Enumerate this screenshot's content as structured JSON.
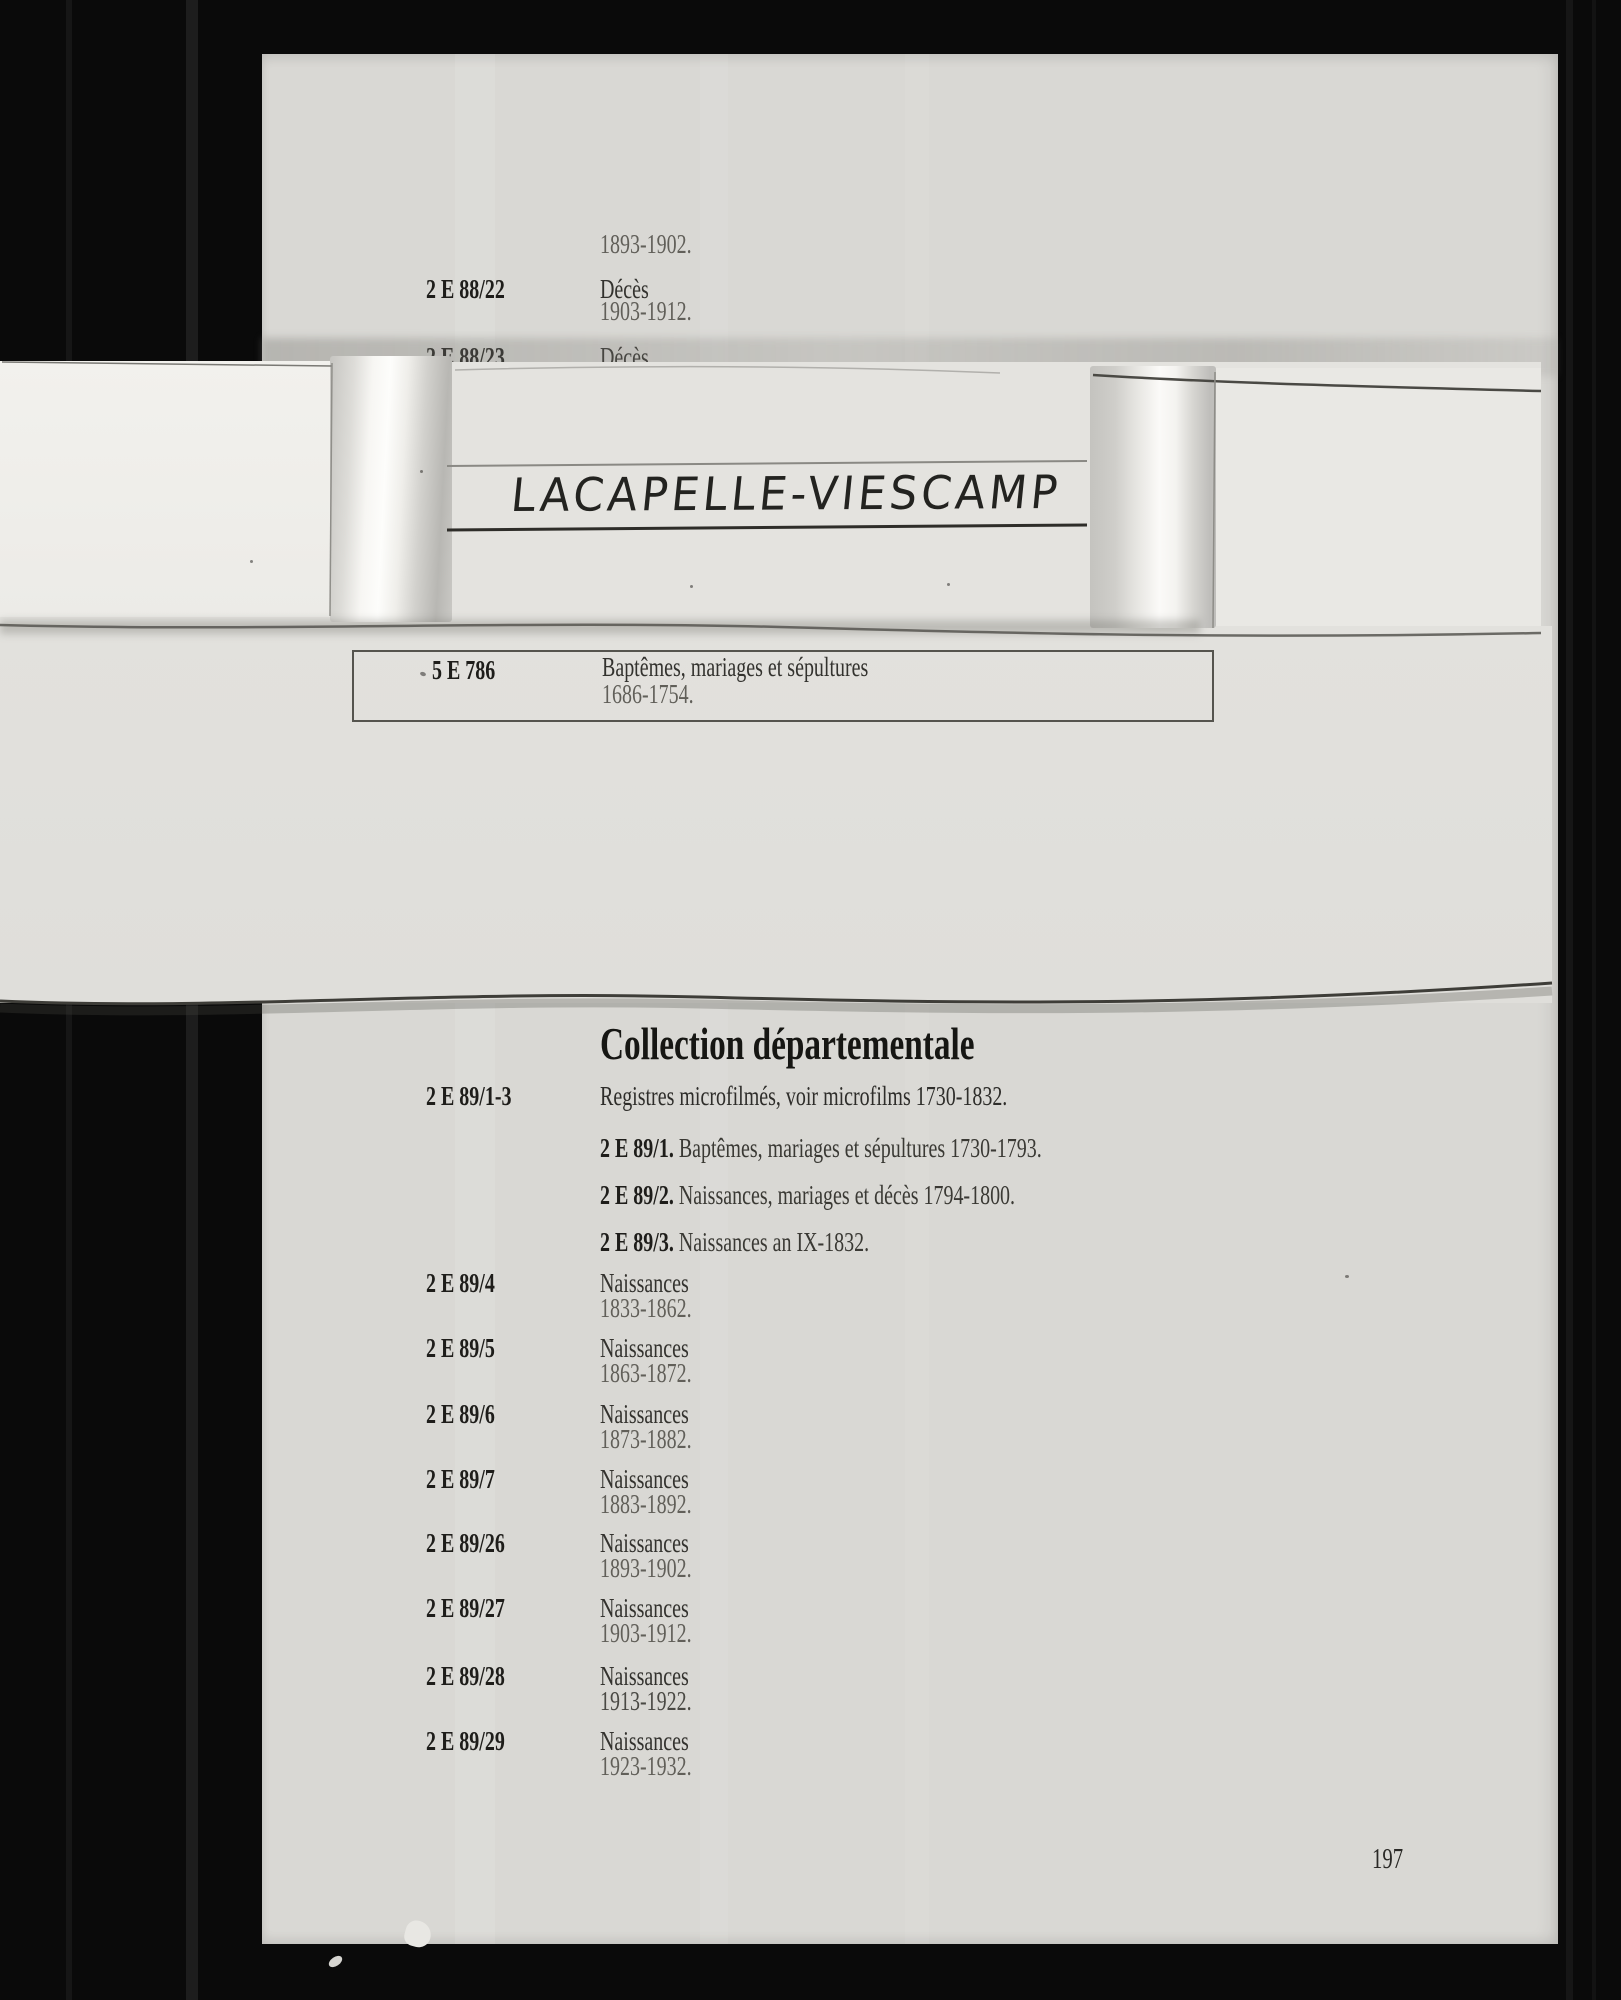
{
  "document": {
    "page_number": "197",
    "top_entries": {
      "orphan_dates": "1893-1902.",
      "rows": [
        {
          "code": "2 E 88/22",
          "label": "Décès",
          "dates": "1903-1912."
        },
        {
          "code": "2 E 88/23",
          "label": "Décès",
          "dates": ""
        }
      ]
    },
    "spine_label": {
      "title": "LACAPELLE-VIESCAMP"
    },
    "boxed_entry": {
      "code": "5 E 786",
      "label": "Baptêmes, mariages et sépultures",
      "dates": "1686-1754."
    },
    "collection": {
      "heading": "Collection départementale",
      "intro": {
        "code": "2 E 89/1-3",
        "label": "Registres microfilmés, voir microfilms 1730-1832."
      },
      "microfilm_items": [
        {
          "code": "2 E 89/1.",
          "label": "Baptêmes, mariages et sépultures 1730-1793."
        },
        {
          "code": "2 E 89/2.",
          "label": "Naissances, mariages et décès 1794-1800."
        },
        {
          "code": "2 E 89/3.",
          "label": "Naissances an IX-1832."
        }
      ],
      "entries": [
        {
          "code": "2 E 89/4",
          "label": "Naissances",
          "dates": "1833-1862."
        },
        {
          "code": "2 E 89/5",
          "label": "Naissances",
          "dates": "1863-1872."
        },
        {
          "code": "2 E 89/6",
          "label": "Naissances",
          "dates": "1873-1882."
        },
        {
          "code": "2 E 89/7",
          "label": "Naissances",
          "dates": "1883-1892."
        },
        {
          "code": "2 E 89/26",
          "label": "Naissances",
          "dates": "1893-1902."
        },
        {
          "code": "2 E 89/27",
          "label": "Naissances",
          "dates": "1903-1912."
        },
        {
          "code": "2 E 89/28",
          "label": "Naissances",
          "dates": "1913-1922."
        },
        {
          "code": "2 E 89/29",
          "label": "Naissances",
          "dates": "1923-1932."
        }
      ]
    },
    "colors": {
      "background": "#0a0a0a",
      "paper": "#d9d8d4",
      "overlay_paper": "#e4e3df",
      "bright_card": "#f1f0ec",
      "ink": "#1e1d1a",
      "faded_ink": "#615f59"
    }
  }
}
